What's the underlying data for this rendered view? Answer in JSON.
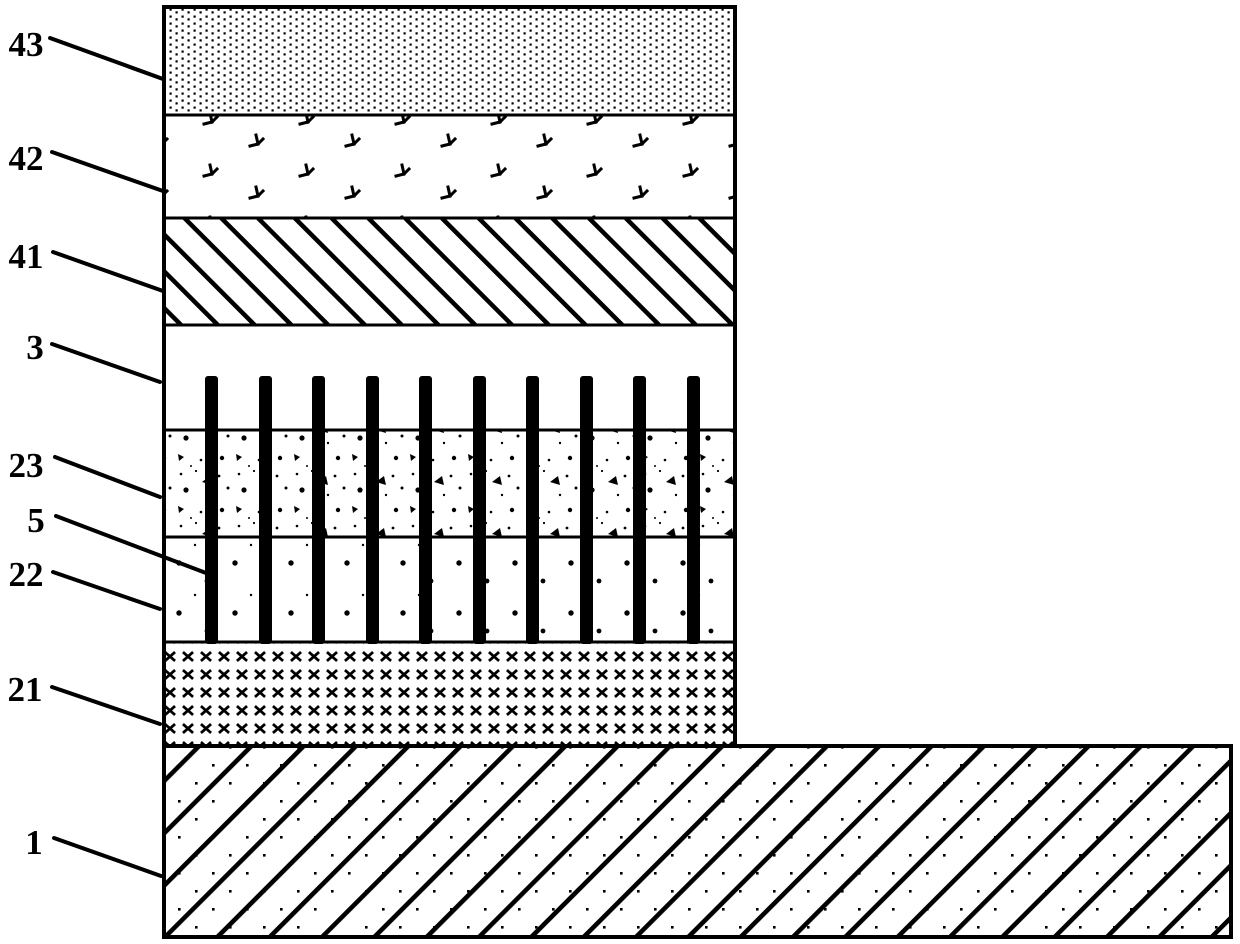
{
  "figure": {
    "description": "Patent-style cross-section diagram of a layered device stack on an L-shaped substrate",
    "background_color": "#ffffff",
    "ink_color": "#000000",
    "labels": [
      {
        "text": "43",
        "refers_to": "top dotted layer"
      },
      {
        "text": "42",
        "refers_to": "arrow-textured layer"
      },
      {
        "text": "41",
        "refers_to": "backslash-hatched layer"
      },
      {
        "text": "3",
        "refers_to": "plain layer with via tops"
      },
      {
        "text": "23",
        "refers_to": "coarse speckled layer"
      },
      {
        "text": "5",
        "refers_to": "vertical via bars"
      },
      {
        "text": "22",
        "refers_to": "sparse speckled layer"
      },
      {
        "text": "21",
        "refers_to": "cross-grid layer"
      },
      {
        "text": "1",
        "refers_to": "substrate slab"
      }
    ],
    "layers": [
      {
        "id": "43",
        "pattern": "dense-dot-grid"
      },
      {
        "id": "42",
        "pattern": "scattered-bird-arrows"
      },
      {
        "id": "41",
        "pattern": "diagonal-hatch-backslash"
      },
      {
        "id": "3",
        "pattern": "plain-white"
      },
      {
        "id": "23",
        "pattern": "coarse-speckle"
      },
      {
        "id": "22",
        "pattern": "sparse-speckle"
      },
      {
        "id": "21",
        "pattern": "bold-x-grid"
      },
      {
        "id": "1",
        "pattern": "diagonal-hatch-slash-with-dots"
      }
    ],
    "vias": {
      "count": 10,
      "label": "5"
    }
  }
}
